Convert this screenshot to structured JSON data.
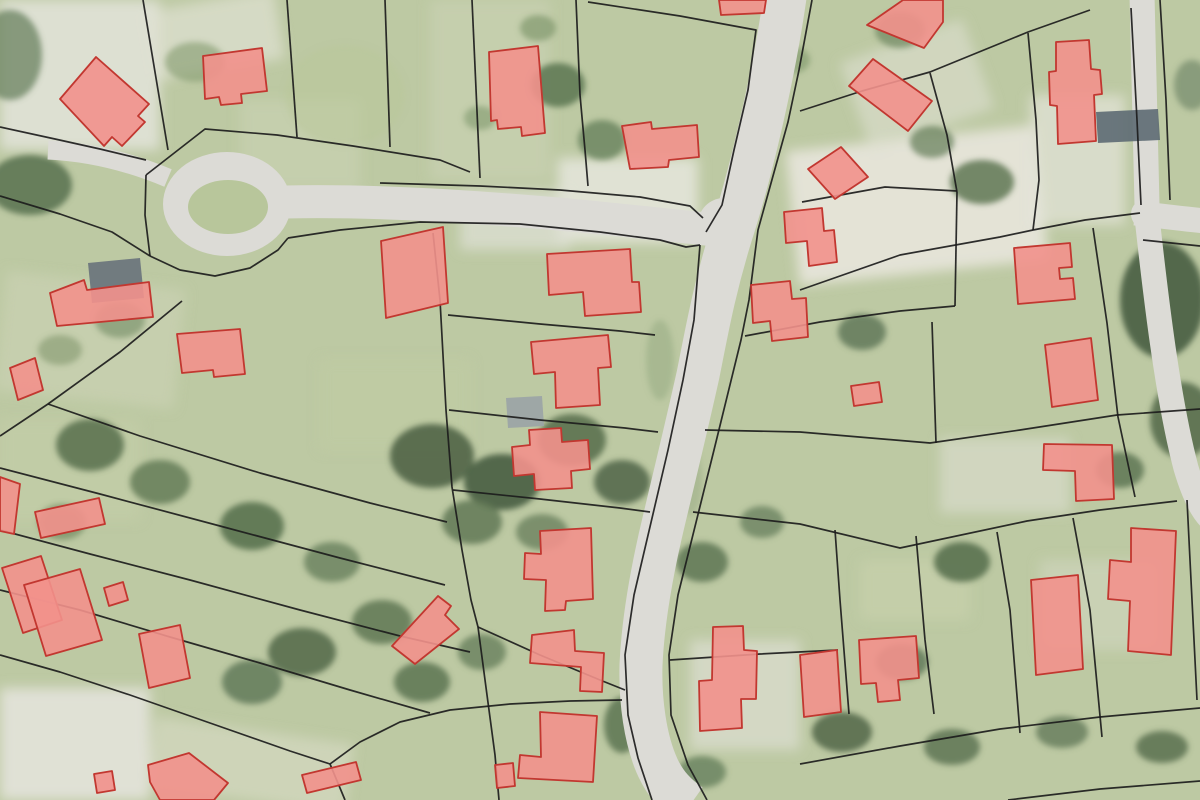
{
  "meta": {
    "description": "Aerial orthophoto map with cadastral parcel boundaries and highlighted building footprints",
    "width": 1200,
    "height": 800
  },
  "map": {
    "colors": {
      "ground": "#bdc9a3",
      "road": "#dcdbd6",
      "parcel_line": "#1c1c1c",
      "building_fill": "#f2918c",
      "building_stroke": "#c23730",
      "island_green": "#b8c69b"
    },
    "culdesac": {
      "cx": 227,
      "cy": 204,
      "rx": 64,
      "ry": 52,
      "island": {
        "cx": 228,
        "cy": 207,
        "rx": 40,
        "ry": 27
      }
    },
    "junction_pads": [
      {
        "cx": 724,
        "cy": 224,
        "r": 26
      },
      {
        "cx": 1146,
        "cy": 214,
        "r": 15
      }
    ],
    "roads": [
      {
        "d": "M 786,-10 C 775,70 752,170 731,235 C 714,290 707,330 698,375 C 688,420 676,470 664,520 C 652,570 643,620 641,665 C 640,700 645,740 658,768 C 666,785 676,795 690,805",
        "w": 43
      },
      {
        "d": "M 285,202 C 380,200 480,207 580,216 C 640,222 680,226 714,230",
        "w": 33
      },
      {
        "d": "M 48,150 C 90,152 130,162 168,178",
        "w": 19
      },
      {
        "d": "M 1142,-5 L 1147,205",
        "w": 25
      },
      {
        "d": "M 1135,213 C 1160,216 1185,219 1205,221",
        "w": 25
      },
      {
        "d": "M 1146,208 C 1156,300 1168,400 1186,468 C 1194,495 1202,510 1210,518",
        "w": 25
      }
    ],
    "patches": [
      {
        "x": 0,
        "y": 0,
        "w": 160,
        "h": 150,
        "rot": 0,
        "fill": "#e3e4da",
        "op": 0.85
      },
      {
        "x": 150,
        "y": 0,
        "w": 130,
        "h": 70,
        "rot": -10,
        "fill": "#dfe1d3",
        "op": 0.7
      },
      {
        "x": 430,
        "y": 0,
        "w": 120,
        "h": 180,
        "rot": 0,
        "fill": "#ccd4b6",
        "op": 0.55
      },
      {
        "x": 792,
        "y": 138,
        "w": 250,
        "h": 135,
        "rot": -6,
        "fill": "#e8e6db",
        "op": 0.9
      },
      {
        "x": 558,
        "y": 158,
        "w": 140,
        "h": 85,
        "rot": 0,
        "fill": "#e9e8e0",
        "op": 0.8
      },
      {
        "x": 0,
        "y": 688,
        "w": 150,
        "h": 112,
        "rot": 0,
        "fill": "#e6e5de",
        "op": 0.85
      },
      {
        "x": 852,
        "y": 38,
        "w": 130,
        "h": 95,
        "rot": -20,
        "fill": "#dde0d0",
        "op": 0.6
      },
      {
        "x": 1030,
        "y": 95,
        "w": 95,
        "h": 130,
        "rot": 0,
        "fill": "#e4e4da",
        "op": 0.7
      },
      {
        "x": 150,
        "y": 730,
        "w": 200,
        "h": 70,
        "rot": 8,
        "fill": "#d9dcc7",
        "op": 0.6
      },
      {
        "x": 940,
        "y": 438,
        "w": 130,
        "h": 75,
        "rot": 0,
        "fill": "#dde0d2",
        "op": 0.6
      },
      {
        "x": 0,
        "y": 280,
        "w": 180,
        "h": 120,
        "rot": 6,
        "fill": "#cfd6b9",
        "op": 0.5
      },
      {
        "x": 690,
        "y": 640,
        "w": 110,
        "h": 110,
        "rot": 0,
        "fill": "#e2e2da",
        "op": 0.6
      },
      {
        "x": 460,
        "y": 190,
        "w": 110,
        "h": 60,
        "rot": 0,
        "fill": "#e0e1d7",
        "op": 0.7
      },
      {
        "x": 1040,
        "y": 560,
        "w": 120,
        "h": 90,
        "rot": 0,
        "fill": "#d6dac5",
        "op": 0.5
      },
      {
        "x": 320,
        "y": 360,
        "w": 150,
        "h": 90,
        "rot": 0,
        "fill": "#c2cda4",
        "op": 0.5
      },
      {
        "x": 860,
        "y": 560,
        "w": 110,
        "h": 60,
        "rot": 0,
        "fill": "#cbd3b0",
        "op": 0.5
      },
      {
        "x": 240,
        "y": 100,
        "w": 120,
        "h": 90,
        "rot": 0,
        "fill": "#ced6b8",
        "op": 0.5
      },
      {
        "x": 0,
        "y": 420,
        "w": 140,
        "h": 100,
        "rot": 0,
        "fill": "#c6cfaa",
        "op": 0.5
      }
    ],
    "vegetation": [
      {
        "cx": 30,
        "cy": 185,
        "rx": 42,
        "ry": 30,
        "fill": "#5d7553",
        "op": 0.9
      },
      {
        "cx": 10,
        "cy": 55,
        "rx": 32,
        "ry": 45,
        "fill": "#6a8160",
        "op": 0.75
      },
      {
        "cx": 195,
        "cy": 62,
        "rx": 30,
        "ry": 20,
        "fill": "#82996d",
        "op": 0.6
      },
      {
        "cx": 558,
        "cy": 85,
        "rx": 27,
        "ry": 22,
        "fill": "#5f7a55",
        "op": 0.9
      },
      {
        "cx": 602,
        "cy": 140,
        "rx": 24,
        "ry": 20,
        "fill": "#6c8660",
        "op": 0.85
      },
      {
        "cx": 538,
        "cy": 28,
        "rx": 18,
        "ry": 13,
        "fill": "#7b9468",
        "op": 0.65
      },
      {
        "cx": 480,
        "cy": 118,
        "rx": 16,
        "ry": 12,
        "fill": "#7e976c",
        "op": 0.6
      },
      {
        "cx": 345,
        "cy": 95,
        "rx": 60,
        "ry": 50,
        "fill": "#b9c79a",
        "op": 0.5
      },
      {
        "cx": 90,
        "cy": 445,
        "rx": 34,
        "ry": 26,
        "fill": "#5c7452",
        "op": 0.9
      },
      {
        "cx": 160,
        "cy": 482,
        "rx": 30,
        "ry": 22,
        "fill": "#657d58",
        "op": 0.85
      },
      {
        "cx": 252,
        "cy": 526,
        "rx": 32,
        "ry": 24,
        "fill": "#5a7250",
        "op": 0.9
      },
      {
        "cx": 332,
        "cy": 562,
        "rx": 28,
        "ry": 20,
        "fill": "#68805c",
        "op": 0.8
      },
      {
        "cx": 62,
        "cy": 522,
        "rx": 24,
        "ry": 18,
        "fill": "#72895f",
        "op": 0.7
      },
      {
        "cx": 432,
        "cy": 456,
        "rx": 42,
        "ry": 32,
        "fill": "#54684b",
        "op": 0.95
      },
      {
        "cx": 502,
        "cy": 482,
        "rx": 38,
        "ry": 28,
        "fill": "#4e6347",
        "op": 0.95
      },
      {
        "cx": 572,
        "cy": 440,
        "rx": 34,
        "ry": 26,
        "fill": "#5b7150",
        "op": 0.9
      },
      {
        "cx": 622,
        "cy": 482,
        "rx": 28,
        "ry": 22,
        "fill": "#556a4c",
        "op": 0.9
      },
      {
        "cx": 472,
        "cy": 522,
        "rx": 30,
        "ry": 22,
        "fill": "#627855",
        "op": 0.85
      },
      {
        "cx": 542,
        "cy": 532,
        "rx": 26,
        "ry": 18,
        "fill": "#6a815e",
        "op": 0.8
      },
      {
        "cx": 382,
        "cy": 622,
        "rx": 30,
        "ry": 22,
        "fill": "#5f7754",
        "op": 0.85
      },
      {
        "cx": 302,
        "cy": 652,
        "rx": 34,
        "ry": 24,
        "fill": "#576d4e",
        "op": 0.9
      },
      {
        "cx": 252,
        "cy": 682,
        "rx": 30,
        "ry": 22,
        "fill": "#62795a",
        "op": 0.85
      },
      {
        "cx": 422,
        "cy": 682,
        "rx": 28,
        "ry": 20,
        "fill": "#5c7452",
        "op": 0.85
      },
      {
        "cx": 482,
        "cy": 652,
        "rx": 24,
        "ry": 18,
        "fill": "#68805c",
        "op": 0.8
      },
      {
        "cx": 702,
        "cy": 562,
        "rx": 26,
        "ry": 20,
        "fill": "#5e7553",
        "op": 0.85
      },
      {
        "cx": 762,
        "cy": 522,
        "rx": 22,
        "ry": 16,
        "fill": "#6a8260",
        "op": 0.8
      },
      {
        "cx": 862,
        "cy": 332,
        "rx": 24,
        "ry": 18,
        "fill": "#60785a",
        "op": 0.85
      },
      {
        "cx": 962,
        "cy": 562,
        "rx": 28,
        "ry": 20,
        "fill": "#5a7150",
        "op": 0.9
      },
      {
        "cx": 902,
        "cy": 662,
        "rx": 26,
        "ry": 18,
        "fill": "#62795a",
        "op": 0.85
      },
      {
        "cx": 842,
        "cy": 732,
        "rx": 30,
        "ry": 20,
        "fill": "#566c4d",
        "op": 0.9
      },
      {
        "cx": 952,
        "cy": 747,
        "rx": 28,
        "ry": 18,
        "fill": "#5d7453",
        "op": 0.85
      },
      {
        "cx": 1062,
        "cy": 732,
        "rx": 26,
        "ry": 16,
        "fill": "#647b5b",
        "op": 0.8
      },
      {
        "cx": 1162,
        "cy": 747,
        "rx": 26,
        "ry": 16,
        "fill": "#59704f",
        "op": 0.85
      },
      {
        "cx": 1162,
        "cy": 300,
        "rx": 42,
        "ry": 58,
        "fill": "#4e6347",
        "op": 0.95
      },
      {
        "cx": 1182,
        "cy": 420,
        "rx": 32,
        "ry": 38,
        "fill": "#576d4e",
        "op": 0.9
      },
      {
        "cx": 982,
        "cy": 182,
        "rx": 32,
        "ry": 22,
        "fill": "#5f7754",
        "op": 0.85
      },
      {
        "cx": 932,
        "cy": 142,
        "rx": 22,
        "ry": 16,
        "fill": "#6b8360",
        "op": 0.75
      },
      {
        "cx": 1192,
        "cy": 85,
        "rx": 18,
        "ry": 25,
        "fill": "#74896b",
        "op": 0.7
      },
      {
        "cx": 622,
        "cy": 725,
        "rx": 18,
        "ry": 28,
        "fill": "#5c7452",
        "op": 0.85
      },
      {
        "cx": 702,
        "cy": 772,
        "rx": 24,
        "ry": 16,
        "fill": "#67805c",
        "op": 0.8
      },
      {
        "cx": 215,
        "cy": 205,
        "rx": 24,
        "ry": 18,
        "fill": "#4f684a",
        "op": 1
      },
      {
        "cx": 120,
        "cy": 320,
        "rx": 25,
        "ry": 18,
        "fill": "#6f8a62",
        "op": 0.6
      },
      {
        "cx": 60,
        "cy": 350,
        "rx": 22,
        "ry": 15,
        "fill": "#7b9168",
        "op": 0.55
      },
      {
        "cx": 900,
        "cy": 30,
        "rx": 25,
        "ry": 18,
        "fill": "#6d8661",
        "op": 0.7
      },
      {
        "cx": 790,
        "cy": 60,
        "rx": 20,
        "ry": 14,
        "fill": "#7b9468",
        "op": 0.6
      },
      {
        "cx": 1120,
        "cy": 470,
        "rx": 24,
        "ry": 18,
        "fill": "#5e7553",
        "op": 0.85
      },
      {
        "cx": 660,
        "cy": 360,
        "rx": 14,
        "ry": 40,
        "fill": "#8fa37c",
        "op": 0.45
      },
      {
        "cx": 690,
        "cy": 480,
        "rx": 12,
        "ry": 35,
        "fill": "#8fa37c",
        "op": 0.4
      }
    ],
    "gray_buildings": [
      {
        "points": "88,263 140,258 144,298 92,303",
        "fill": "#68727b"
      },
      {
        "points": "506,398 542,396 544,426 508,428",
        "fill": "#9aa3a6"
      },
      {
        "points": "1096,112 1158,109 1160,140 1098,143",
        "fill": "#5d6a73"
      }
    ],
    "parcel_lines": [
      "143,0 168,150",
      "287,0 297,137",
      "385,0 390,147",
      "472,0 480,178",
      "576,0 580,95 585,150 588,186",
      "588,2 680,16 756,30 748,90 734,150 722,205 706,232",
      "812,0 799,70 788,122 758,230 749,300 741,340 714,450 678,595 669,655 671,715 688,765 707,800",
      "700,245 694,320 683,380 668,450 634,595 625,655 628,715 638,758 652,800",
      "146,175 205,129 277,135 353,146 440,160 470,172",
      "380,183 480,186 560,190 640,197 690,206 703,218",
      "288,238 340,230 420,222 520,224 600,232 660,240 686,247 700,245",
      "150,256 180,270 215,276 250,268 278,250 288,238",
      "146,175 145,215 150,256",
      "0,127 55,139 100,149 146,160",
      "0,196 60,214 112,232 150,256",
      "182,301 120,352 48,404 0,436",
      "48,404 140,436 260,473 370,503 447,522",
      "0,468 100,494 220,526 340,558 445,585",
      "0,530 90,554 190,580 300,610 400,636 470,652",
      "0,590 80,610 170,637 260,663 350,690 430,713",
      "0,655 60,672 130,695 210,723 290,751 330,764 345,800",
      "330,764 360,742 400,722 450,710 510,704 570,701 622,700",
      "433,233 440,300 446,410 452,487 462,550 471,600 478,627 487,695 495,755 499,800",
      "448,315 540,324 620,331 655,335",
      "449,410 540,420 625,428 658,432",
      "453,490 540,499 620,508 650,512",
      "478,627 540,655 600,680 625,690",
      "800,111 862,91 930,72 1028,32 1090,10",
      "930,73 947,135 957,192",
      "1028,33 1036,120 1039,180 1033,230",
      "1033,230 1085,220 1140,213",
      "1131,8 1137,120 1141,205",
      "802,202 885,187 957,191",
      "957,192 955,306",
      "800,290 900,255 1000,237 1033,230",
      "745,336 820,322 900,311 955,306",
      "705,430 800,432 930,443 1020,430 1117,415 1200,409",
      "693,512 800,524 900,548 1027,521 1100,510 1177,501",
      "932,322 936,443",
      "997,532 1010,610 1020,733",
      "1073,518 1090,610 1102,737",
      "1187,500 1192,600 1197,700",
      "800,764 900,746 1000,729 1100,717 1200,708",
      "1008,800 1100,789 1200,781",
      "835,530 840,600 849,714",
      "916,536 925,640 934,714",
      "1093,228 1107,323 1118,417 1135,497",
      "1143,240 1200,246",
      "670,660 760,654 838,650",
      "1160,0 1166,100 1170,200"
    ],
    "buildings": [
      "60,99 96,57 149,104 138,116 145,122 122,146 112,137 104,146",
      "203,56 262,48 267,91 241,94 242,103 221,105 219,97 205,99",
      "489,52 538,46 545,133 522,136 521,127 498,129 497,120 491,121",
      "622,126 651,122 652,129 697,125 699,157 669,160 668,167 630,169",
      "719,0 766,0 764,13 721,15",
      "849,86 873,59 932,101 908,131",
      "1056,42 1089,40 1091,69 1100,70 1102,94 1094,95 1096,141 1058,144 1057,106 1050,105 1049,72 1056,71",
      "808,169 841,147 868,177 835,199",
      "784,212 822,208 824,231 834,230 837,262 809,266 807,241 786,243",
      "751,285 790,281 792,299 806,298 808,337 772,341 770,321 753,323",
      "1014,248 1070,243 1072,267 1059,268 1060,279 1073,278 1075,299 1018,304",
      "1045,345 1091,338 1098,400 1052,407",
      "1044,444 1112,445 1114,499 1076,501 1075,471 1043,470",
      "851,386 879,382 882,402 854,406",
      "177,334 240,329 245,374 214,377 213,370 182,373",
      "50,293 84,280 87,290 149,282 153,317 57,326",
      "10,368 35,358 43,390 18,400",
      "0,477 20,484 14,534 0,531",
      "35,512 99,498 105,524 41,538",
      "2,568 41,556 62,620 23,633",
      "24,585 80,569 102,640 46,656",
      "104,588 123,582 128,600 109,606",
      "139,634 180,625 190,678 149,688",
      "94,774 112,771 115,790 97,793",
      "148,765 189,753 228,783 214,800 160,800 150,782",
      "302,775 356,762 361,780 307,793",
      "495,765 513,763 515,786 497,788",
      "540,712 597,716 593,782 518,778 520,755 541,757",
      "532,635 574,630 575,651 604,653 602,692 580,691 581,667 530,663",
      "392,646 438,596 451,606 445,615 459,629 415,664",
      "547,254 630,249 632,282 639,282 641,312 585,316 583,292 549,295",
      "531,342 608,335 611,367 598,368 600,405 556,408 555,372 534,374",
      "512,447 530,445 529,430 561,428 562,442 588,440 590,469 571,471 572,488 535,490 534,474 514,476",
      "540,531 591,528 593,599 566,601 565,610 545,611 546,580 524,579 525,553 541,554",
      "713,627 743,626 744,650 757,651 756,699 741,699 742,728 700,731 699,681 712,680",
      "800,655 837,650 841,712 804,717",
      "859,640 916,636 919,678 898,680 900,700 878,702 876,683 861,684",
      "1031,580 1078,575 1083,669 1036,675",
      "1131,528 1176,531 1171,655 1128,651 1130,601 1108,599 1110,560 1131,562",
      "867,25 903,0 943,0 943,22 924,48",
      "381,241 443,227 448,303 386,318"
    ]
  }
}
